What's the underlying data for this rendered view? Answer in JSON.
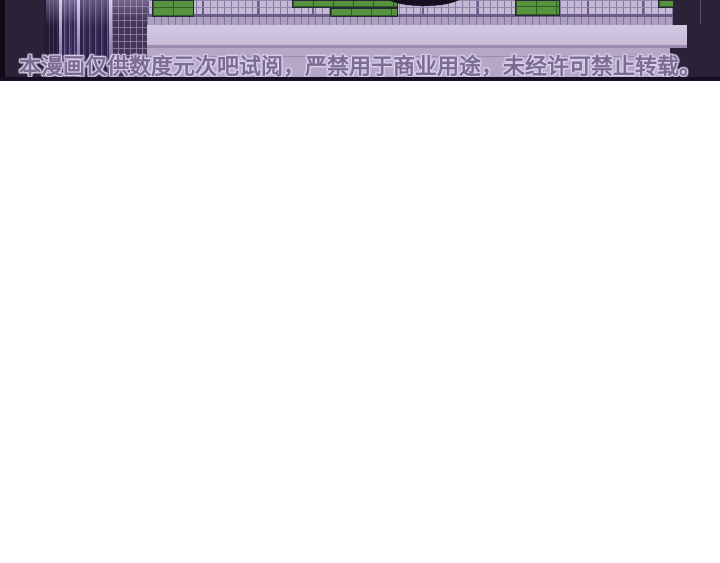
{
  "comic": {
    "watermark_text": "本漫画仅供数度元次吧试阅，严禁用于商业用途，未经许可禁止转载。"
  },
  "colors": {
    "page-bg": "#ffffff",
    "strip-dark-bg": "#2a2236",
    "border-black": "#0e0a16",
    "purple-panel": "#6f55a0",
    "blind-dark": "#2c2145",
    "blind-mid": "#6f5e94",
    "gap-light": "#d9cdee",
    "lattice": "#443656",
    "fence-bg": "#c4b8d4",
    "fence-line": "#8579a0",
    "base-band": "#ada0c0",
    "wall-light": "#d3c8e2",
    "wall-lower": "#b5a8c7",
    "window-green": "#57923f",
    "window-green-dark": "#2f5c28",
    "arc-black": "#141020",
    "watermark-fill": "#7b6c92",
    "watermark-glow": "#ddd2ee",
    "bottom-border": "#151026"
  }
}
